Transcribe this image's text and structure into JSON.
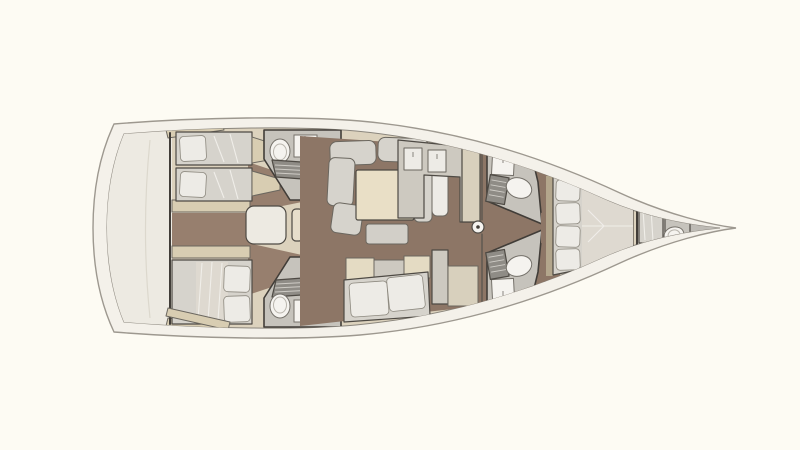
{
  "title": "Sailing yacht interior layout floor plan, top view, bow pointing right",
  "orientation": {
    "bow": "right",
    "stern": "left"
  },
  "colors": {
    "background": "#fdfbf3",
    "deck_white": "#f4f1ea",
    "hull_line": "#9d988f",
    "interior_base": "#dcd2bd",
    "stern_platform": "#edeae2",
    "floor_wood": "#8d7666",
    "floor_corridor": "#977f6e",
    "bath_floor": "#c6c3bc",
    "upholstery": "#d6d3cc",
    "cushion_white": "#edebe6",
    "blanket": "#ded9d0",
    "table_cream": "#e9dfc6",
    "bench": "#d2cfc8",
    "cabinet_tan": "#d8cdb2",
    "cabinet_tan_light": "#e4dbc3",
    "cabinet_grey": "#cdc9c0",
    "unit_beige": "#d8d0bd",
    "steps": "#e7decb",
    "grate": "#8f8c86",
    "slat_locker": "#c5c1b8",
    "fixture_white": "#f5f3ef",
    "bow_locker": "#bebbb5",
    "wall": "#413d38",
    "headboard": "#b3a68c"
  },
  "regions": [
    {
      "id": "stern-platform",
      "kind": "deck"
    },
    {
      "id": "aft-cabin-port",
      "kind": "cabin",
      "beds": 2
    },
    {
      "id": "aft-cabin-starboard",
      "kind": "cabin",
      "beds": 1
    },
    {
      "id": "aft-head-port",
      "kind": "bathroom",
      "fixtures": [
        "toilet",
        "sink",
        "shower-grate",
        "locker"
      ]
    },
    {
      "id": "aft-head-starboard",
      "kind": "bathroom",
      "fixtures": [
        "toilet",
        "sink",
        "shower-grate",
        "locker"
      ]
    },
    {
      "id": "companionway",
      "kind": "stairs",
      "steps": 3
    },
    {
      "id": "saloon",
      "kind": "living",
      "items": [
        "u-sofa",
        "table",
        "bench"
      ]
    },
    {
      "id": "galley",
      "kind": "galley"
    },
    {
      "id": "mast-post",
      "kind": "structure"
    },
    {
      "id": "fwd-head-port",
      "kind": "bathroom",
      "fixtures": [
        "toilet",
        "sink",
        "shower-grate"
      ]
    },
    {
      "id": "fwd-head-starboard",
      "kind": "bathroom",
      "fixtures": [
        "toilet",
        "sink",
        "shower-grate"
      ]
    },
    {
      "id": "owner-cabin",
      "kind": "cabin",
      "beds": 1,
      "pillows": 4
    },
    {
      "id": "bow-cabin",
      "kind": "cabin",
      "beds": 1,
      "fixtures": [
        "toilet",
        "sink"
      ]
    },
    {
      "id": "bow-sail-locker",
      "kind": "storage"
    }
  ]
}
